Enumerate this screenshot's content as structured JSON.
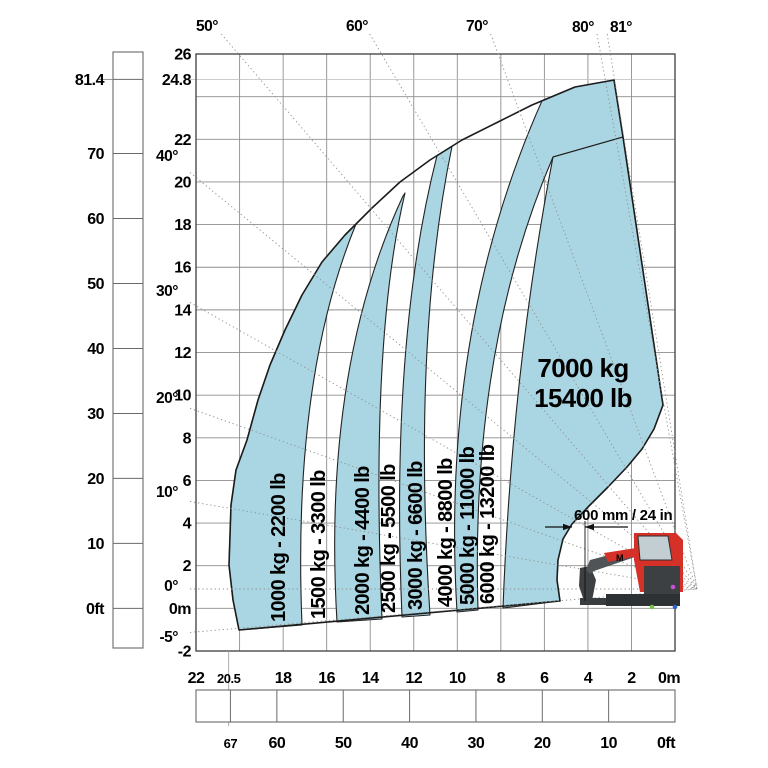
{
  "chart_data": {
    "type": "area",
    "subtype": "telehandler-load-capacity-envelope",
    "title": "",
    "capacity_zones": [
      {
        "capacity_kg": 1000,
        "label": "1000 kg - 2200 lb",
        "fill": "blue"
      },
      {
        "capacity_kg": 1500,
        "label": "1500 kg - 3300 lb",
        "fill": "white"
      },
      {
        "capacity_kg": 2000,
        "label": "2000 kg - 4400 lb",
        "fill": "blue"
      },
      {
        "capacity_kg": 2500,
        "label": "2500 kg - 5500 lb",
        "fill": "white"
      },
      {
        "capacity_kg": 3000,
        "label": "3000 kg - 6600 lb",
        "fill": "blue"
      },
      {
        "capacity_kg": 4000,
        "label": "4000 kg - 8800 lb",
        "fill": "white"
      },
      {
        "capacity_kg": 5000,
        "label": "5000 kg - 11000 lb",
        "fill": "blue"
      },
      {
        "capacity_kg": 6000,
        "label": "6000 kg - 13200 lb",
        "fill": "white"
      },
      {
        "capacity_kg": 7000,
        "label_line1": "7000 kg",
        "label_line2": "15400 lb",
        "fill": "blue"
      }
    ],
    "axes": {
      "height_m": {
        "unit": "m",
        "ticks": [
          {
            "v": 26,
            "label": "26"
          },
          {
            "v": 24.8,
            "label": "24.8"
          },
          {
            "v": 22,
            "label": "22"
          },
          {
            "v": 20,
            "label": "20"
          },
          {
            "v": 18,
            "label": "18"
          },
          {
            "v": 16,
            "label": "16"
          },
          {
            "v": 14,
            "label": "14"
          },
          {
            "v": 12,
            "label": "12"
          },
          {
            "v": 10,
            "label": "10"
          },
          {
            "v": 8,
            "label": "8"
          },
          {
            "v": 6,
            "label": "6"
          },
          {
            "v": 4,
            "label": "4"
          },
          {
            "v": 2,
            "label": "2"
          },
          {
            "v": 0,
            "label": "0m"
          },
          {
            "v": -2,
            "label": "-2"
          }
        ]
      },
      "height_ft": {
        "unit": "ft",
        "ticks": [
          {
            "v": 81.4,
            "label": "81.4"
          },
          {
            "v": 70,
            "label": "70"
          },
          {
            "v": 60,
            "label": "60"
          },
          {
            "v": 50,
            "label": "50"
          },
          {
            "v": 40,
            "label": "40"
          },
          {
            "v": 30,
            "label": "30"
          },
          {
            "v": 20,
            "label": "20"
          },
          {
            "v": 10,
            "label": "10"
          },
          {
            "v": 0,
            "label": "0ft"
          }
        ]
      },
      "reach_m": {
        "unit": "m",
        "ticks": [
          {
            "v": 22,
            "label": "22"
          },
          {
            "v": 20.5,
            "label": "20.5",
            "small": true
          },
          {
            "v": 18,
            "label": "18"
          },
          {
            "v": 16,
            "label": "16"
          },
          {
            "v": 14,
            "label": "14"
          },
          {
            "v": 12,
            "label": "12"
          },
          {
            "v": 10,
            "label": "10"
          },
          {
            "v": 8,
            "label": "8"
          },
          {
            "v": 6,
            "label": "6"
          },
          {
            "v": 4,
            "label": "4"
          },
          {
            "v": 2,
            "label": "2"
          },
          {
            "v": 0,
            "label": "0m",
            "dx": -6
          }
        ]
      },
      "reach_ft": {
        "unit": "ft",
        "ticks": [
          {
            "v": 67,
            "label": "67",
            "small": true
          },
          {
            "v": 60,
            "label": "60"
          },
          {
            "v": 50,
            "label": "50"
          },
          {
            "v": 40,
            "label": "40"
          },
          {
            "v": 30,
            "label": "30"
          },
          {
            "v": 20,
            "label": "20"
          },
          {
            "v": 10,
            "label": "10"
          },
          {
            "v": 0,
            "label": "0ft",
            "dx": -9
          }
        ]
      }
    },
    "boom_angles": {
      "top": [
        {
          "label": "50°",
          "deg": 50,
          "lx": 207,
          "ly": 31
        },
        {
          "label": "60°",
          "deg": 60,
          "lx": 357,
          "ly": 31
        },
        {
          "label": "70°",
          "deg": 70,
          "lx": 477,
          "ly": 31
        },
        {
          "label": "80°",
          "deg": 80,
          "lx": 583,
          "ly": 32
        },
        {
          "label": "81°",
          "deg": 81,
          "lx": 621,
          "ly": 32
        }
      ],
      "left": [
        {
          "label": "40°",
          "deg": 40,
          "ly": 161
        },
        {
          "label": "30°",
          "deg": 30,
          "ly": 296
        },
        {
          "label": "20°",
          "deg": 20,
          "ly": 403
        },
        {
          "label": "10°",
          "deg": 10,
          "ly": 497
        },
        {
          "label": "0°",
          "deg": 0,
          "ly": 591
        },
        {
          "label": "-5°",
          "deg": -5,
          "ly": 642
        }
      ]
    },
    "annotation_600mm": "600 mm / 24 in",
    "machine_logo": "M",
    "colors": {
      "zone_blue": "#a9d6e2",
      "outline": "#1c1c1c",
      "grid": "#8d8d8d",
      "grid_light": "#bcbcbc",
      "dotted": "#8f8f8f",
      "ruler": "#6a6a6a",
      "machine_red": "#d63129",
      "machine_dark": "#3c4043",
      "cab_gray": "#c3ced3",
      "dot_magenta": "#c84fd4",
      "dot_green": "#76c043",
      "dot_blue": "#2f63cc"
    },
    "geometry_px": {
      "plot": {
        "left": 196,
        "top": 54,
        "right": 675,
        "bottom": 651,
        "px_per_m_x": 21.77,
        "px_per_m_y": 21.32,
        "ground_y": 608.4
      },
      "pivot": [
        697,
        589
      ],
      "aspect_factor": 0.979,
      "arc": [
        [
          239,
          630
        ],
        [
          233,
          600
        ],
        [
          229,
          565
        ],
        [
          231,
          505
        ],
        [
          236,
          470
        ],
        [
          247,
          440
        ],
        [
          258,
          400
        ],
        [
          270,
          365
        ],
        [
          285,
          330
        ],
        [
          302,
          295
        ],
        [
          322,
          262
        ],
        [
          345,
          235
        ],
        [
          372,
          208
        ],
        [
          400,
          182
        ],
        [
          430,
          160
        ],
        [
          462,
          140
        ],
        [
          498,
          122
        ],
        [
          532,
          105
        ],
        [
          575,
          87
        ],
        [
          614,
          80
        ]
      ],
      "right_edge": [
        [
          614,
          80
        ],
        [
          623,
          137
        ],
        [
          663,
          405
        ]
      ],
      "cutout": [
        [
          663,
          405
        ],
        [
          654,
          429
        ],
        [
          642,
          449
        ],
        [
          627,
          467
        ],
        [
          608,
          487
        ],
        [
          588,
          507
        ],
        [
          572,
          524
        ],
        [
          563,
          539
        ],
        [
          558,
          560
        ],
        [
          557,
          580
        ],
        [
          560,
          601
        ]
      ],
      "bottom_corner": [
        239,
        630
      ],
      "inner_corner": [
        560,
        601
      ],
      "internal_line": [
        [
          553,
          157
        ],
        [
          623,
          137
        ]
      ],
      "zone_paths": {
        "z1000": {
          "b": [
            302,
            625
          ],
          "ctrl": [
            292,
            380
          ],
          "arc_end_x": 356
        },
        "z2000": {
          "b1": [
            337,
            622
          ],
          "c1": [
            322,
            370
          ],
          "t1": [
            403,
            196
          ],
          "t2": [
            405,
            193
          ],
          "c2": [
            370,
            340
          ],
          "b2": [
            382,
            619
          ]
        },
        "z3000": {
          "b1": [
            402,
            617
          ],
          "c1": [
            390,
            340
          ],
          "ax1": 437,
          "ax2": 452,
          "c2": [
            412,
            340
          ],
          "b2": [
            430,
            615
          ]
        },
        "z5000": {
          "b1": [
            457,
            612
          ],
          "c1": [
            440,
            330
          ],
          "ax1": 542,
          "pinch": [
            553,
            157
          ],
          "c2": [
            470,
            350
          ],
          "b2": [
            478,
            610
          ]
        },
        "z7000": {
          "b1": [
            503,
            608
          ],
          "c1": [
            512,
            370
          ],
          "pinch": [
            553,
            157
          ]
        }
      },
      "zone_label_anchors": [
        [
          285,
          622
        ],
        [
          325,
          619
        ],
        [
          369,
          615
        ],
        [
          395,
          613
        ],
        [
          422,
          610
        ],
        [
          452,
          607
        ],
        [
          474,
          605
        ],
        [
          494,
          604
        ]
      ],
      "zone7000_label_pos": [
        [
          583,
          377
        ],
        [
          583,
          407
        ]
      ],
      "left_ruler": {
        "x": 113,
        "y": 52,
        "w": 30,
        "h": 596,
        "leader_y": 79.4
      },
      "bottom_ruler": {
        "x": 196,
        "y": 690,
        "w": 479,
        "h": 32
      },
      "maxreach_line_x": 228.7,
      "dimension": {
        "text_x": 574,
        "text_y": 520,
        "line_y": 527,
        "tail1": [
          545,
          558
        ],
        "tip1": 572,
        "tip2": 585,
        "tail2": [
          599,
          628
        ],
        "ref_line": [
          585,
          521,
          601
        ]
      },
      "machine": {
        "fork_blade": [
          [
            580,
            598
          ],
          [
            615,
            598
          ],
          [
            615,
            605
          ],
          [
            580,
            605
          ]
        ],
        "carriage": [
          [
            580,
            568
          ],
          [
            590,
            566
          ],
          [
            596,
            580
          ],
          [
            592,
            601
          ],
          [
            584,
            601
          ],
          [
            579,
            586
          ]
        ],
        "boom": [
          [
            586,
            570
          ],
          [
            590,
            560
          ],
          [
            636,
            548
          ],
          [
            662,
            549
          ],
          [
            662,
            557
          ],
          [
            638,
            556
          ],
          [
            594,
            571
          ],
          [
            590,
            574
          ]
        ],
        "boom_sleeve": [
          [
            604,
            553
          ],
          [
            636,
            548
          ],
          [
            638,
            556
          ],
          [
            608,
            562
          ]
        ],
        "body": [
          [
            634,
            533
          ],
          [
            676,
            533
          ],
          [
            683,
            540
          ],
          [
            683,
            592
          ],
          [
            640,
            592
          ],
          [
            634,
            560
          ]
        ],
        "cab_window": [
          [
            638,
            536
          ],
          [
            668,
            536
          ],
          [
            672,
            560
          ],
          [
            640,
            560
          ]
        ],
        "lower_panel": [
          644,
          566,
          36,
          30
        ],
        "bottom_bar": [
          606,
          594,
          74,
          12
        ],
        "logo_pos": [
          616,
          561
        ],
        "dots": [
          [
            673,
            587,
            "dot_magenta"
          ],
          [
            652,
            607,
            "dot_green"
          ],
          [
            675,
            607,
            "dot_blue"
          ]
        ]
      }
    }
  }
}
